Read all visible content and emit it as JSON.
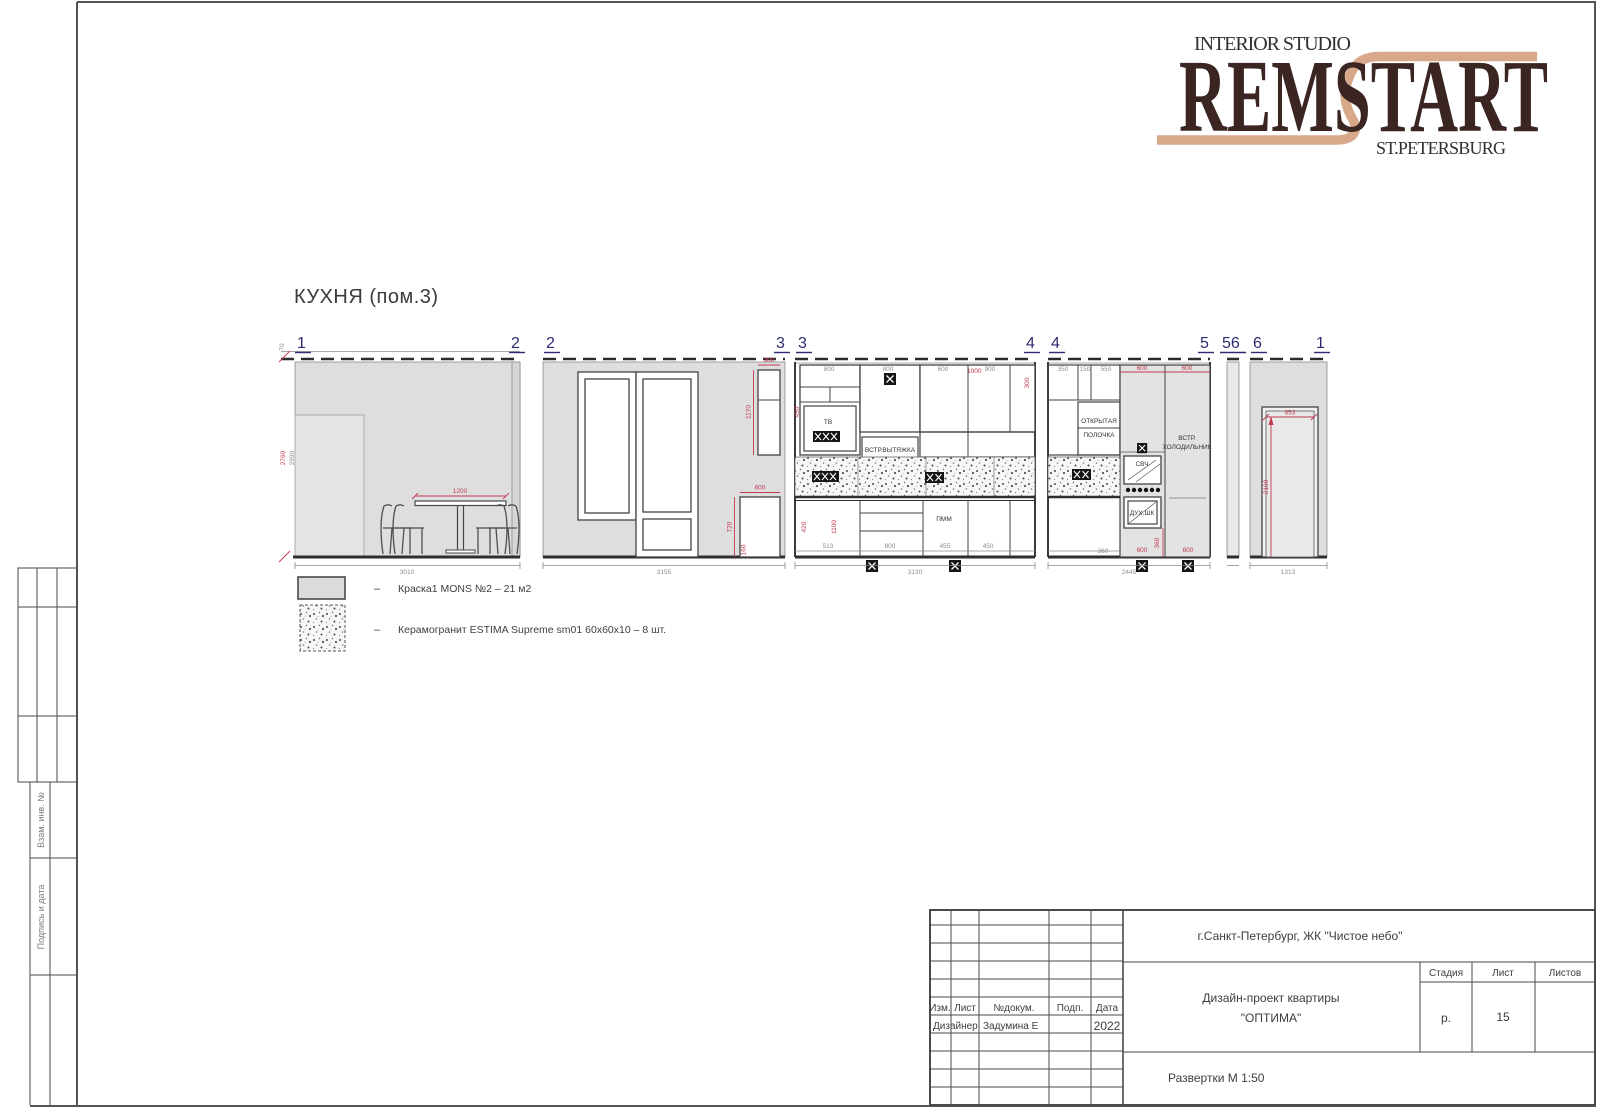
{
  "brand": {
    "tagline": "INTERIOR STUDIO",
    "name": "REMSTART",
    "city": "ST.PETERSBURG",
    "color_dark": "#3a2522",
    "color_tan": "#d8a88b"
  },
  "sheet": {
    "title": "КУХНЯ  (пом.3)"
  },
  "markers": {
    "e1l": "1",
    "e1r": "2",
    "e2l": "2",
    "e2r": "3",
    "e3l": "3",
    "e3r": "4",
    "e4l": "4",
    "e4r": "5",
    "e5": "56",
    "e6l": "6",
    "e6r": "1"
  },
  "e1": {
    "dims": {
      "gap": "70",
      "h_red": "2760",
      "h_gray": "2690",
      "table": "1200",
      "width": "3010"
    }
  },
  "e2": {
    "dims": {
      "w_top": "300",
      "h_top": "1170",
      "w_bot": "600",
      "h_bot": "720",
      "plinth": "160",
      "width": "3155"
    }
  },
  "e3": {
    "labels": {
      "tv": "ТВ",
      "hood": "ВСТР.ВЫТЯЖКА",
      "dw": "ПММ"
    },
    "dims": {
      "t1": "800",
      "t2": "800",
      "t3": "600",
      "t4": "900",
      "t_red": "1000",
      "r_red": "300",
      "l1": "450",
      "l2": "420",
      "l3": "1100",
      "b1": "513",
      "b2": "800",
      "b3": "455",
      "b4": "450",
      "width": "3130"
    }
  },
  "e4": {
    "labels": {
      "shelf1": "ОТКРЫТАЯ",
      "shelf2": "ПОЛОЧКА",
      "fridge1": "ВСТР.",
      "fridge2": "ХОЛОДИЛЬНИК",
      "mw": "СВЧ",
      "oven": "ДУХ.ШК"
    },
    "dims": {
      "t1": "350",
      "t2": "150",
      "t3": "550",
      "t4": "600",
      "t5": "600",
      "v1": "360",
      "bg": "360",
      "b2": "600",
      "b3": "600",
      "width": "2445"
    }
  },
  "e6": {
    "dims": {
      "door_w": "853",
      "door_h": "2100",
      "width": "1313"
    }
  },
  "legend": {
    "dash": "–",
    "items": [
      {
        "name": "paint",
        "label": "Краска1  MONS  №2  –  21 м2"
      },
      {
        "name": "tile",
        "label": "Керамогранит  ESTIMA  Supreme  sm01  60х60х10  –  8 шт."
      }
    ]
  },
  "titleblock": {
    "location": "г.Санкт-Петербург,  ЖК  \"Чистое небо\"",
    "doc1": "Дизайн-проект  квартиры",
    "doc2": "\"ОПТИМА\"",
    "view_title": "Развертки    М  1:50",
    "h_izm": "Изм.",
    "h_list": "Лист",
    "h_doc": "№докум.",
    "h_sign": "Подп.",
    "h_date": "Дата",
    "r_role": "Дизайнер",
    "r_name": "Задумина Е",
    "r_year": "2022",
    "h_stage": "Стадия",
    "h_sheet": "Лист",
    "h_sheets": "Листов",
    "stage": "р.",
    "sheet_no": "15"
  },
  "side": {
    "v1": "Взам. инв. №",
    "v2": "Подпись и дата"
  }
}
